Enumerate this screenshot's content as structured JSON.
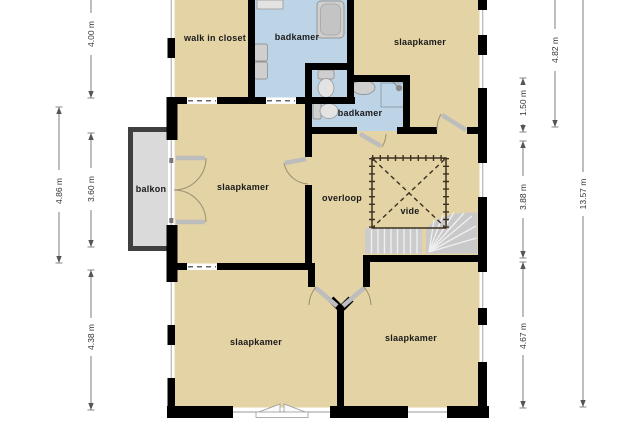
{
  "plan": {
    "title": "first floor plan (verdieping)",
    "rooms": [
      {
        "id": "walk-in-closet",
        "label": "walk in closet"
      },
      {
        "id": "badkamer-top",
        "label": "badkamer"
      },
      {
        "id": "slaapkamer-top-right",
        "label": "slaapkamer"
      },
      {
        "id": "badkamer-middle",
        "label": "badkamer"
      },
      {
        "id": "slaapkamer-middle-left",
        "label": "slaapkamer"
      },
      {
        "id": "overloop",
        "label": "overloop"
      },
      {
        "id": "vide",
        "label": "vide"
      },
      {
        "id": "balkon",
        "label": "balkon"
      },
      {
        "id": "slaapkamer-bottom-left",
        "label": "slaapkamer"
      },
      {
        "id": "slaapkamer-bottom-right",
        "label": "slaapkamer"
      }
    ],
    "dimensions": {
      "left": [
        {
          "label": "4.00 m"
        },
        {
          "label": "4.86 m"
        },
        {
          "label": "3.60 m"
        },
        {
          "label": "4.38 m"
        }
      ],
      "right": [
        {
          "label": "4.82 m"
        },
        {
          "label": "1.50 m"
        },
        {
          "label": "3.88 m"
        },
        {
          "label": "13.57 m"
        },
        {
          "label": "4.67 m"
        }
      ]
    },
    "colors": {
      "room_fill": "#e4d3a5",
      "bathroom_fill": "#bdd4e7",
      "balcony_fill": "#dadada",
      "balcony_wall": "#3f3f3f",
      "wall": "#000000",
      "stairs_fill": "#cccccc",
      "dimension_line": "#7d7d7d",
      "label_color": "#1a1a1a"
    }
  }
}
